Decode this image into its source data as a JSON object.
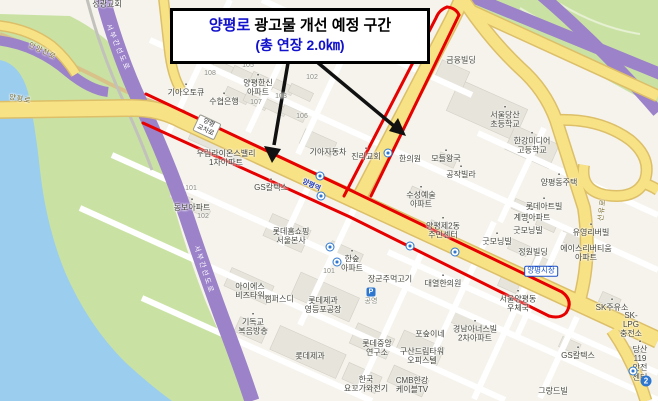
{
  "title_box": {
    "line1_highlight": "양평로",
    "line1_rest": " 광고물 개선 예정 구간",
    "line2": "(총 연장 2.0㎞)"
  },
  "colors": {
    "route_red": "#e60000",
    "road_yellow": "#f8e286",
    "expressway_purple": "#9c82c9",
    "water_blue": "#9bcdef",
    "park_green": "#c9e2a4",
    "title_blue": "#1212cc",
    "transit_blue": "#2e77d0"
  },
  "map": {
    "labels": [
      {
        "t": "성광교회",
        "x": 107,
        "y": 4,
        "cls": "poi"
      },
      {
        "t": "기아오토큐",
        "x": 186,
        "y": 90,
        "cls": "poi",
        "icon": true
      },
      {
        "t": "수협은행",
        "x": 224,
        "y": 99,
        "cls": "poi",
        "icon": true
      },
      {
        "t": "108",
        "x": 210,
        "y": 74,
        "cls": "num"
      },
      {
        "t": "105",
        "x": 248,
        "y": 66,
        "cls": "num"
      },
      {
        "t": "104",
        "x": 278,
        "y": 61,
        "cls": "num"
      },
      {
        "t": "양평한신\n아파트",
        "x": 258,
        "y": 85,
        "cls": "poi",
        "icon": true
      },
      {
        "t": "103",
        "x": 281,
        "y": 97,
        "cls": "num"
      },
      {
        "t": "102",
        "x": 312,
        "y": 78,
        "cls": "num"
      },
      {
        "t": "107",
        "x": 256,
        "y": 103,
        "cls": "num"
      },
      {
        "t": "106",
        "x": 302,
        "y": 117,
        "cls": "num"
      },
      {
        "t": "우림라이온스밸리\n1차아파트",
        "x": 226,
        "y": 158,
        "cls": "poi"
      },
      {
        "t": "기아자동차",
        "x": 328,
        "y": 152,
        "cls": "poi"
      },
      {
        "t": "진리교회",
        "x": 366,
        "y": 154,
        "cls": "poi",
        "icon": true
      },
      {
        "t": "금융빌딩",
        "x": 461,
        "y": 60,
        "cls": "poi"
      },
      {
        "t": "서울당산\n초등학교",
        "x": 505,
        "y": 117,
        "cls": "poi",
        "icon": true
      },
      {
        "t": "한강미디어\n고등학교",
        "x": 532,
        "y": 143,
        "cls": "poi",
        "icon": true
      },
      {
        "t": "양평동주택",
        "x": 559,
        "y": 180,
        "cls": "poi",
        "icon": true
      },
      {
        "t": "모들왕국",
        "x": 446,
        "y": 156,
        "cls": "poi",
        "icon": true
      },
      {
        "t": "공작빌라",
        "x": 461,
        "y": 172,
        "cls": "poi",
        "icon": true
      },
      {
        "t": "한의원",
        "x": 410,
        "y": 159,
        "cls": "poi"
      },
      {
        "t": "수성예술\n아파트",
        "x": 421,
        "y": 197,
        "cls": "poi",
        "icon": true
      },
      {
        "t": "양평제2동\n주민센터",
        "x": 443,
        "y": 228,
        "cls": "poi",
        "icon": true
      },
      {
        "t": "굿모닝빌",
        "x": 528,
        "y": 228,
        "cls": "poi",
        "icon": true
      },
      {
        "t": "굿모닝빌",
        "x": 497,
        "y": 239,
        "cls": "poi",
        "icon": true
      },
      {
        "t": "롯데아트빌",
        "x": 544,
        "y": 204,
        "cls": "poi",
        "icon": true
      },
      {
        "t": "계명아파트",
        "x": 532,
        "y": 215,
        "cls": "poi",
        "icon": true
      },
      {
        "t": "유영리버빌",
        "x": 591,
        "y": 230,
        "cls": "poi",
        "icon": true
      },
      {
        "t": "에이스리버티움\n아파트",
        "x": 586,
        "y": 253,
        "cls": "poi"
      },
      {
        "t": "정원빌딩",
        "x": 533,
        "y": 252,
        "cls": "poi"
      },
      {
        "t": "양평시장",
        "x": 541,
        "y": 271,
        "cls": "market"
      },
      {
        "t": "서울양평동\n우체국",
        "x": 518,
        "y": 301,
        "cls": "poi",
        "icon": true
      },
      {
        "t": "SK주유소",
        "x": 612,
        "y": 305,
        "cls": "poi",
        "icon": true
      },
      {
        "t": "SK-LPG\n충전소",
        "x": 631,
        "y": 325,
        "cls": "poi"
      },
      {
        "t": "당산119\n안전센터",
        "x": 640,
        "y": 361,
        "cls": "poi",
        "icon": true
      },
      {
        "t": "GS칼텍스",
        "x": 578,
        "y": 353,
        "cls": "poi",
        "icon": true
      },
      {
        "t": "그랑드빌",
        "x": 553,
        "y": 391,
        "cls": "poi"
      },
      {
        "t": "롯데홈쇼핑\n서울본사",
        "x": 291,
        "y": 236,
        "cls": "poi"
      },
      {
        "t": "한숲\n아파트",
        "x": 352,
        "y": 261,
        "cls": "poi",
        "icon": true
      },
      {
        "t": "101",
        "x": 329,
        "y": 272,
        "cls": "num"
      },
      {
        "t": "장군주먹고기",
        "x": 390,
        "y": 279,
        "cls": "poi"
      },
      {
        "t": "대열한의원",
        "x": 443,
        "y": 281,
        "cls": "poi",
        "icon": true
      },
      {
        "t": "공영",
        "x": 371,
        "y": 302,
        "cls": "num"
      },
      {
        "t": "롯데제과\n영등포공장",
        "x": 323,
        "y": 305,
        "cls": "poi"
      },
      {
        "t": "아이에스\n비즈타워",
        "x": 250,
        "y": 291,
        "cls": "poi"
      },
      {
        "t": "캠퍼스디",
        "x": 279,
        "y": 299,
        "cls": "poi"
      },
      {
        "t": "기독교\n복음방송",
        "x": 253,
        "y": 324,
        "cls": "poi",
        "icon": true
      },
      {
        "t": "롯데제과",
        "x": 310,
        "y": 356,
        "cls": "poi"
      },
      {
        "t": "롯데중앙\n연구소",
        "x": 377,
        "y": 348,
        "cls": "poi"
      },
      {
        "t": "구산드림타워\n오피스텔",
        "x": 422,
        "y": 356,
        "cls": "poi"
      },
      {
        "t": "한국\n요꼬가와전기",
        "x": 366,
        "y": 384,
        "cls": "poi"
      },
      {
        "t": "CMB한강\n케이블TV",
        "x": 412,
        "y": 385,
        "cls": "poi"
      },
      {
        "t": "경남아너스빌\n2차아파트",
        "x": 475,
        "y": 331,
        "cls": "poi",
        "icon": true
      },
      {
        "t": "포숲이네",
        "x": 430,
        "y": 334,
        "cls": "poi"
      },
      {
        "t": "동보아파트",
        "x": 192,
        "y": 205,
        "cls": "poi",
        "icon": true
      },
      {
        "t": "101",
        "x": 191,
        "y": 189,
        "cls": "num"
      },
      {
        "t": "102",
        "x": 203,
        "y": 217,
        "cls": "num"
      },
      {
        "t": "GS칼텍스",
        "x": 271,
        "y": 185,
        "cls": "poi",
        "icon": true
      },
      {
        "t": "양평로",
        "x": 20,
        "y": 100,
        "cls": "road",
        "rot": 10
      },
      {
        "t": "양평역",
        "x": 311,
        "y": 186,
        "cls": "station",
        "rot": 25
      },
      {
        "t": "양평\n교차로",
        "x": 207,
        "y": 127,
        "cls": "chip",
        "rot": 25
      },
      {
        "t": "서부간선도로",
        "x": 117,
        "y": 48,
        "cls": "hwy",
        "rot": 67
      },
      {
        "t": "서부간선도로",
        "x": 203,
        "y": 270,
        "cls": "hwy",
        "rot": 72
      },
      {
        "t": "안양천로",
        "x": 42,
        "y": 52,
        "cls": "road",
        "rot": 26
      },
      {
        "t": "선유로",
        "x": 603,
        "y": 210,
        "cls": "road",
        "rot": -83
      }
    ],
    "transit_icons": [
      {
        "x": 320,
        "y": 176
      },
      {
        "x": 321,
        "y": 196
      },
      {
        "x": 388,
        "y": 153
      },
      {
        "x": 330,
        "y": 247
      },
      {
        "x": 337,
        "y": 262
      },
      {
        "x": 410,
        "y": 246
      },
      {
        "x": 455,
        "y": 252
      },
      {
        "x": 633,
        "y": 371
      }
    ],
    "subway_badges": [
      {
        "text": "2",
        "x": 646,
        "y": 381
      }
    ],
    "parking_badges": [
      {
        "text": "P",
        "x": 371,
        "y": 292
      }
    ]
  }
}
